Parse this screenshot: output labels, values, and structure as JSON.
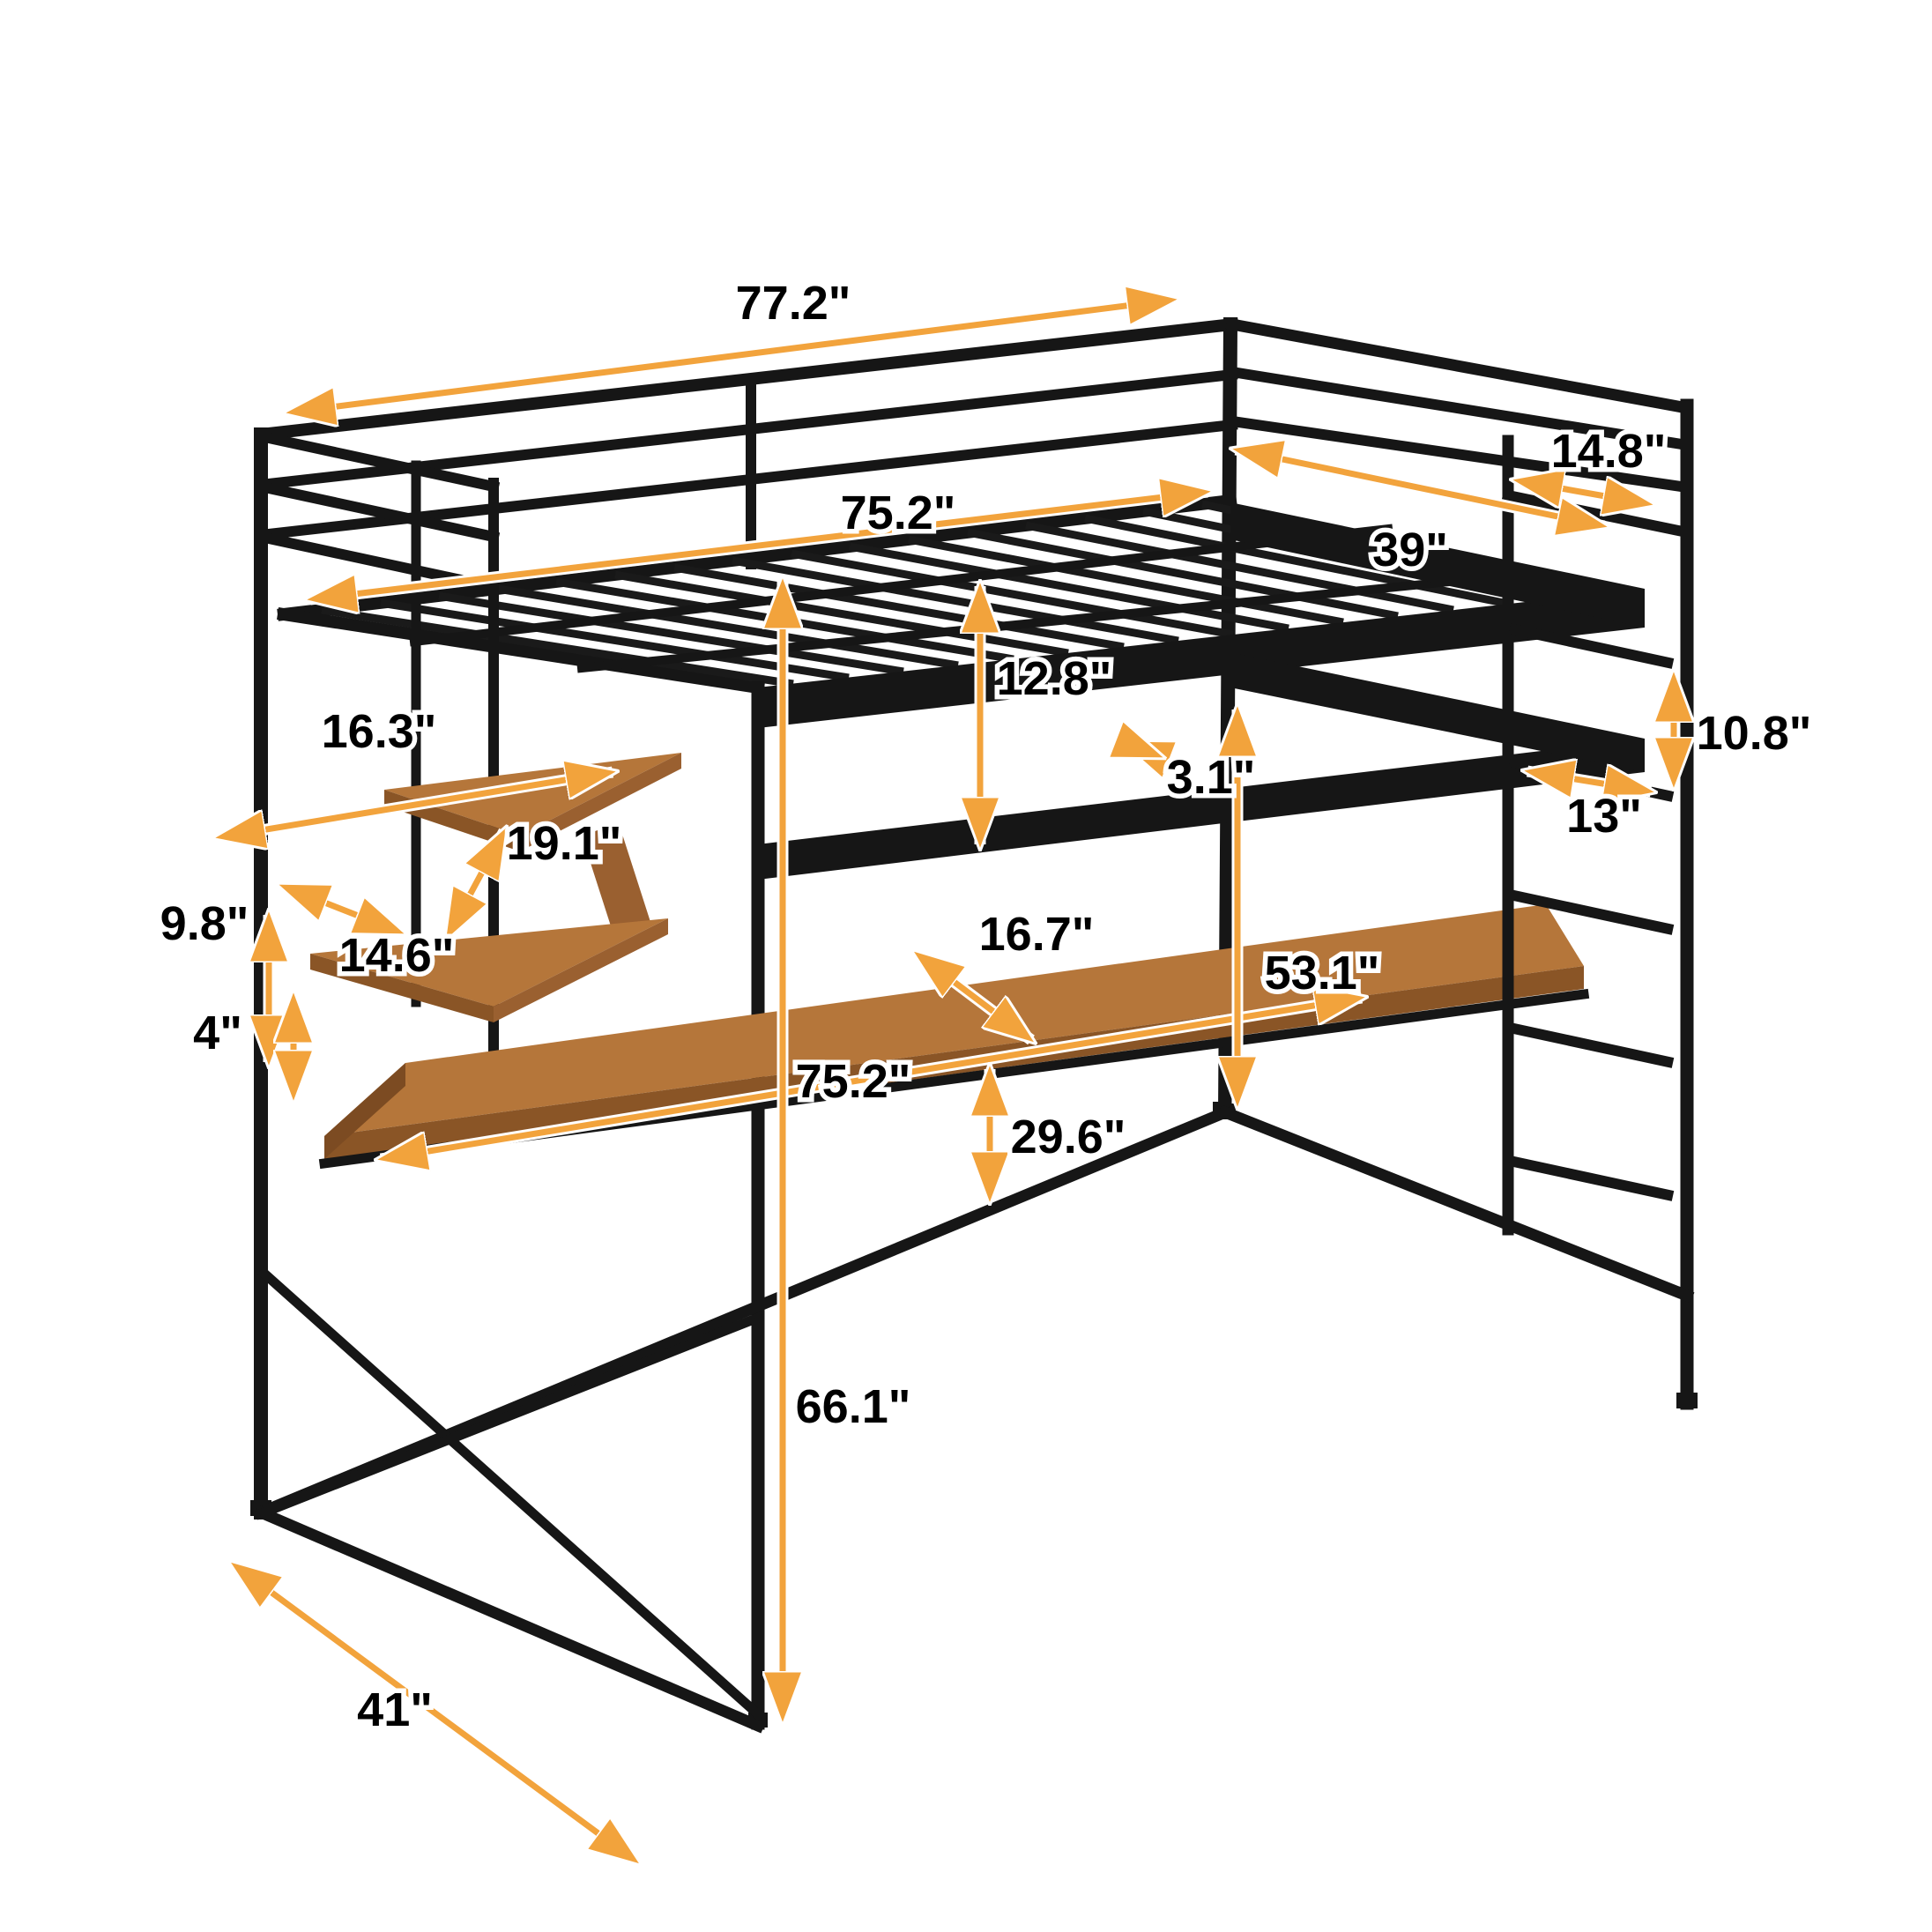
{
  "diagram_type": "loft-bed-with-desk-dimension-diagram",
  "colors": {
    "accent_arrow": "#F2A33C",
    "frame_black": "#161616",
    "wood_top": "#B5763A",
    "wood_edge": "#8A5526",
    "background": "#FFFFFF",
    "label_text": "#000000",
    "label_halo": "#FFFFFF"
  },
  "dims": [
    {
      "id": "overall-length",
      "label": "77.2\""
    },
    {
      "id": "bed-inner-length",
      "label": "75.2\""
    },
    {
      "id": "head-rail-section",
      "label": "14.8\""
    },
    {
      "id": "bed-width",
      "label": "39\""
    },
    {
      "id": "guardrail-height",
      "label": "12.8\""
    },
    {
      "id": "frame-bar-thickness",
      "label": "3.1\""
    },
    {
      "id": "shelf-length",
      "label": "16.3\""
    },
    {
      "id": "shelf-diagonal",
      "label": "19.1\""
    },
    {
      "id": "shelf-depth",
      "label": "14.6\""
    },
    {
      "id": "shelf-gap",
      "label": "9.8\""
    },
    {
      "id": "shelf-to-desk-gap",
      "label": "4\""
    },
    {
      "id": "desk-depth",
      "label": "16.7\""
    },
    {
      "id": "desk-length",
      "label": "75.2\""
    },
    {
      "id": "desk-height",
      "label": "29.6\""
    },
    {
      "id": "under-bed-clearance",
      "label": "53.1\""
    },
    {
      "id": "ladder-rung-spacing",
      "label": "10.8\""
    },
    {
      "id": "ladder-rung-width",
      "label": "13\""
    },
    {
      "id": "total-height",
      "label": "66.1\""
    },
    {
      "id": "overall-depth",
      "label": "41\""
    }
  ]
}
